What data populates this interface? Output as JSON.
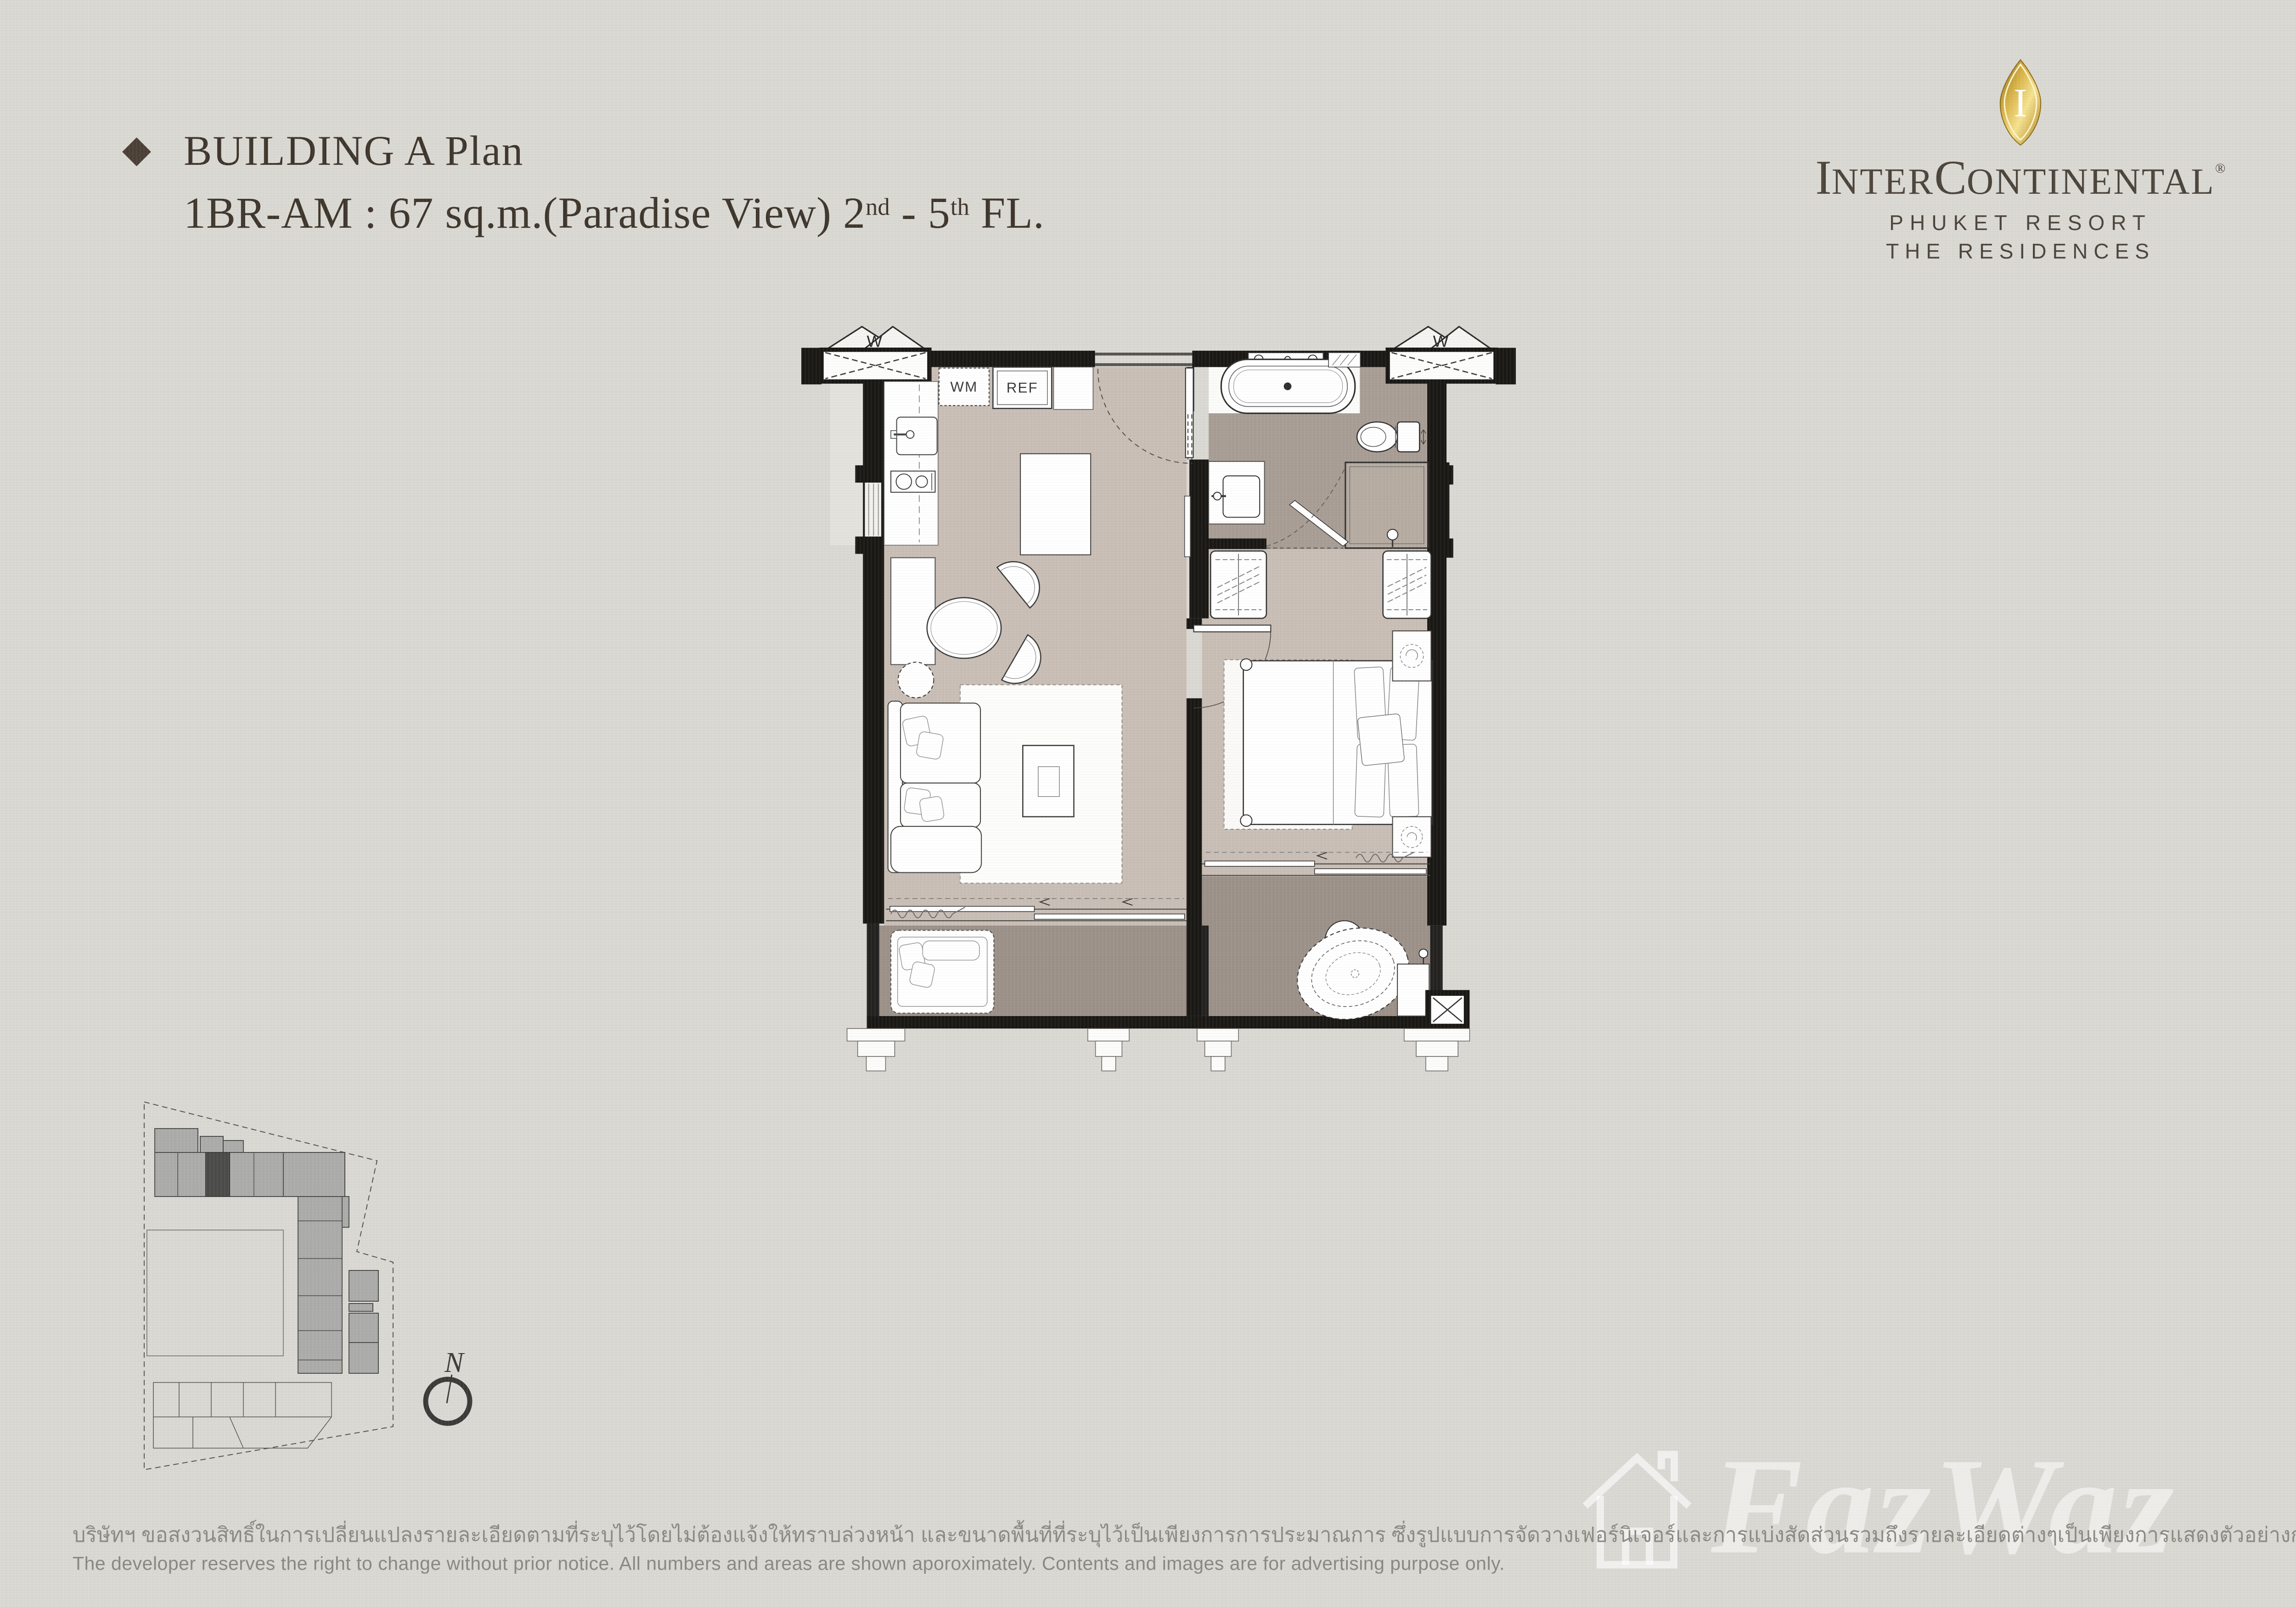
{
  "page": {
    "background": "#dad8d3"
  },
  "header": {
    "bullet": "◆",
    "title": "BUILDING A Plan",
    "unit": {
      "p1": "1BR-AM : 67 sq.m.(Paradise View) 2",
      "sup1": "nd",
      "p2": " - 5",
      "sup2": "th",
      "p3": " FL."
    }
  },
  "logo": {
    "emblem_letter": "I",
    "brand": {
      "i1": "I",
      "s1": "NTER",
      "c": "C",
      "s2": "ONTINENTAL",
      "reg": "®"
    },
    "line2": "PHUKET RESORT",
    "line3": "THE RESIDENCES",
    "gold": "#c9a035"
  },
  "plan": {
    "labels": {
      "wm": "WM",
      "ref": "REF",
      "w_left": "W",
      "w_right": "W"
    },
    "colors": {
      "floor_main": "#c9beb5",
      "floor_bath": "#a89d94",
      "floor_shower": "#b6aba1",
      "floor_terrace": "#9c9189",
      "wall": "#1a1815"
    }
  },
  "key_plan": {
    "north": "N"
  },
  "watermark": {
    "text": "FazWaz"
  },
  "footer": {
    "thai": "บริษัทฯ ขอสงวนสิทธิ์ในการเปลี่ยนแปลงรายละเอียดตามที่ระบุไว้โดยไม่ต้องแจ้งให้ทราบล่วงหน้า และขนาดพื้นที่ที่ระบุไว้เป็นเพียงการการประมาณการ ซึ่งรูปแบบการจัดวางเฟอร์นิเจอร์และการแบ่งสัดส่วนรวมถึงรายละเอียดต่างๆเป็นเพียงการแสดงตัวอย่างการจัดวางพื้นที่ใช้สอยและเพื่อการโฆษณาเท่านั้น",
    "english": "The developer reserves the right to change without prior notice. All numbers and areas are shown aporoximately. Contents and images are for advertising purpose only."
  }
}
